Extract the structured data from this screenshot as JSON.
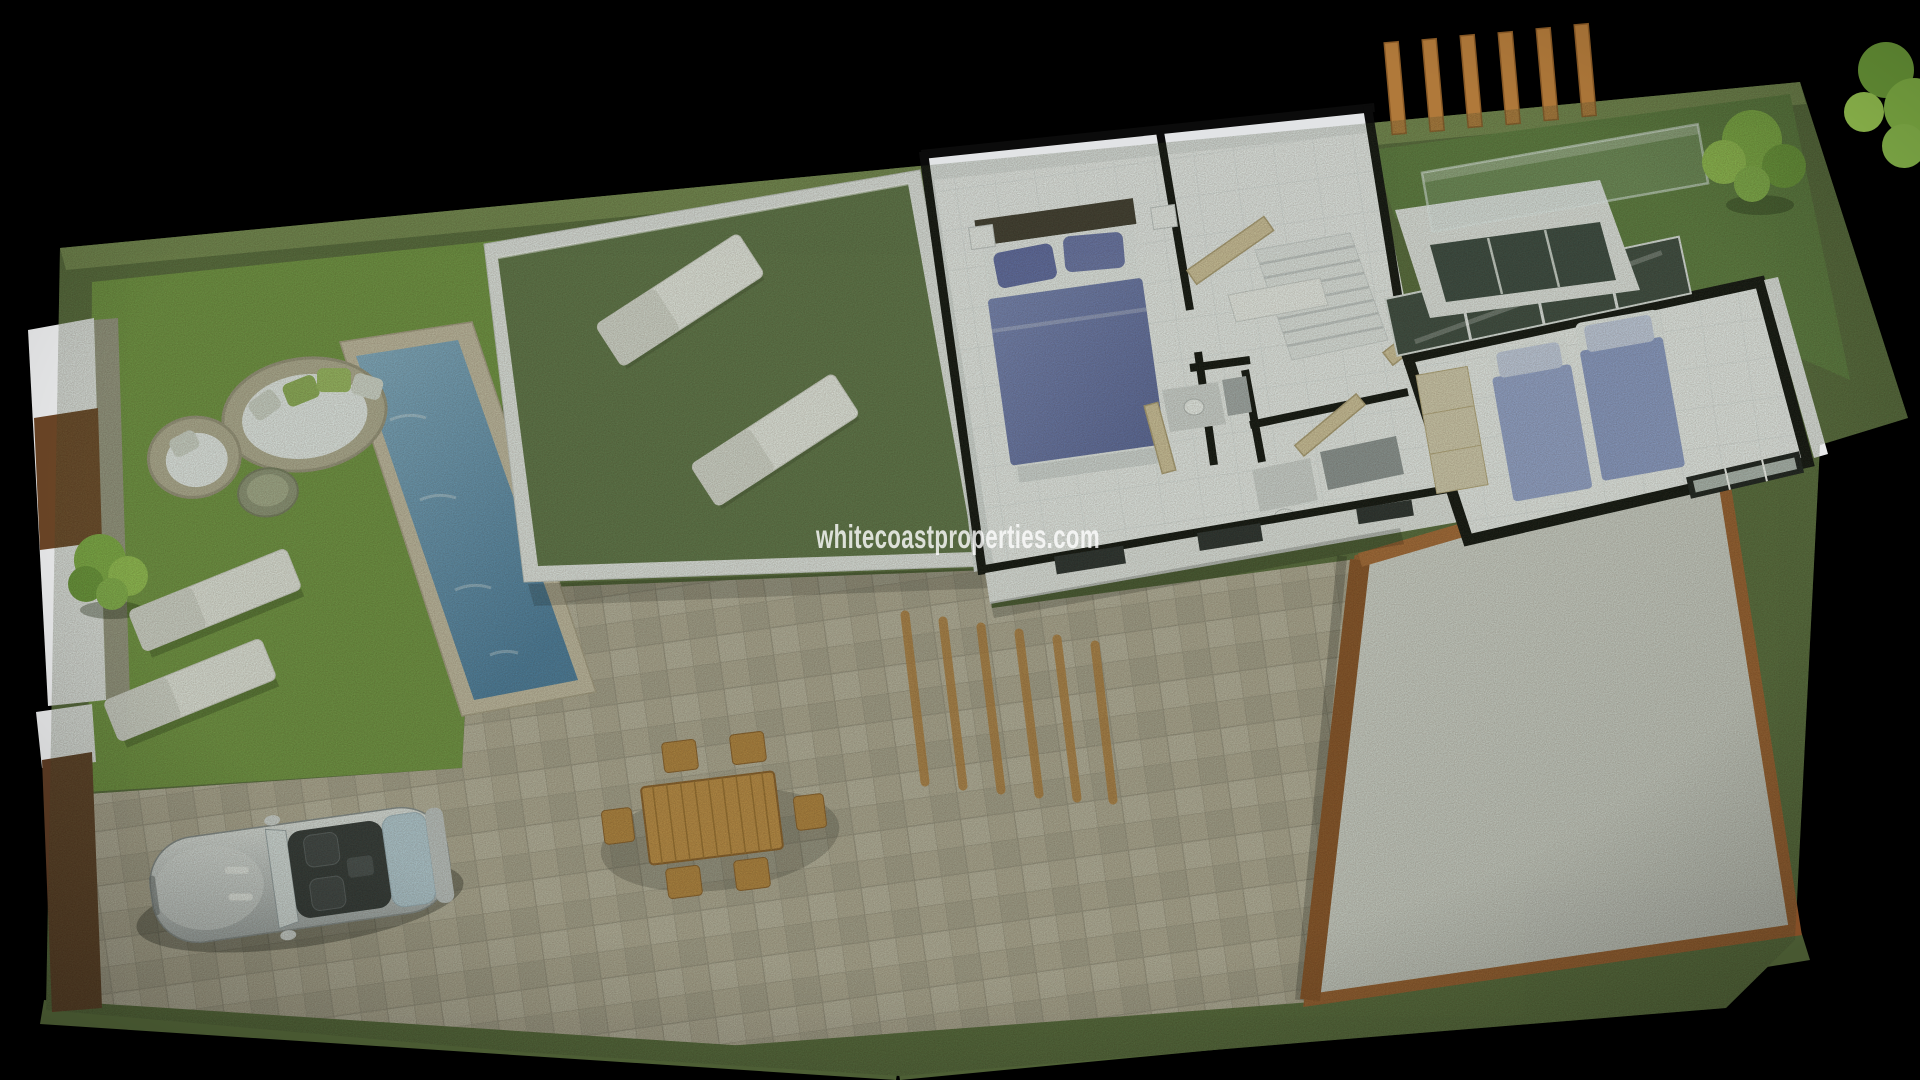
{
  "page": {
    "type": "3d-architectural-render",
    "subject": "aerial cutaway render of a villa plot with garden, pool, roof terrace and furnished first floor",
    "background": "#000000"
  },
  "watermark": {
    "text": "whitecoastproperties.com",
    "color": "#ffffff",
    "opacity": 0.8
  },
  "palette": {
    "hedge": "#55683a",
    "hedge_light": "#7d9155",
    "lawn": "#6f9340",
    "terrace_grass": "#5d7247",
    "courtyard_grass": "#5b7a3e",
    "tile": "#b2a997",
    "tile_alt": "#a8a08f",
    "tile_line": "#9b9384",
    "floor": "#f1f2f4",
    "floor_line": "#e0e3e7",
    "wall_white": "#e8e9ea",
    "wall_cut": "#0b0b0b",
    "pool_coping": "#c6bba6",
    "pool_light": "#85aecb",
    "pool_dark": "#497aa2",
    "wood": "#b5813c",
    "wood_dark": "#8a5a26",
    "pergola": "#b0793a",
    "deck": "#d2d2cf",
    "deck_border": "#9a5a2c",
    "brown_wall": "#5e3c24",
    "car_seat": "#33363a",
    "car_tonneau": "#b7ccdb",
    "bed_duvet": "#6670aa",
    "bed_pillow": "#5f68a8",
    "single_bed": "#97a4d4",
    "single_bed_alt": "#8d9bce",
    "door_wood": "#d6c5a0",
    "cushion_white": "#eceff1",
    "pillow_green": "#8fae58",
    "tree_green": "#7fae44",
    "tree_dark": "#6a9838",
    "tree_light": "#94c050",
    "glazing": "#3a453f",
    "watermark": "#ffffff"
  }
}
